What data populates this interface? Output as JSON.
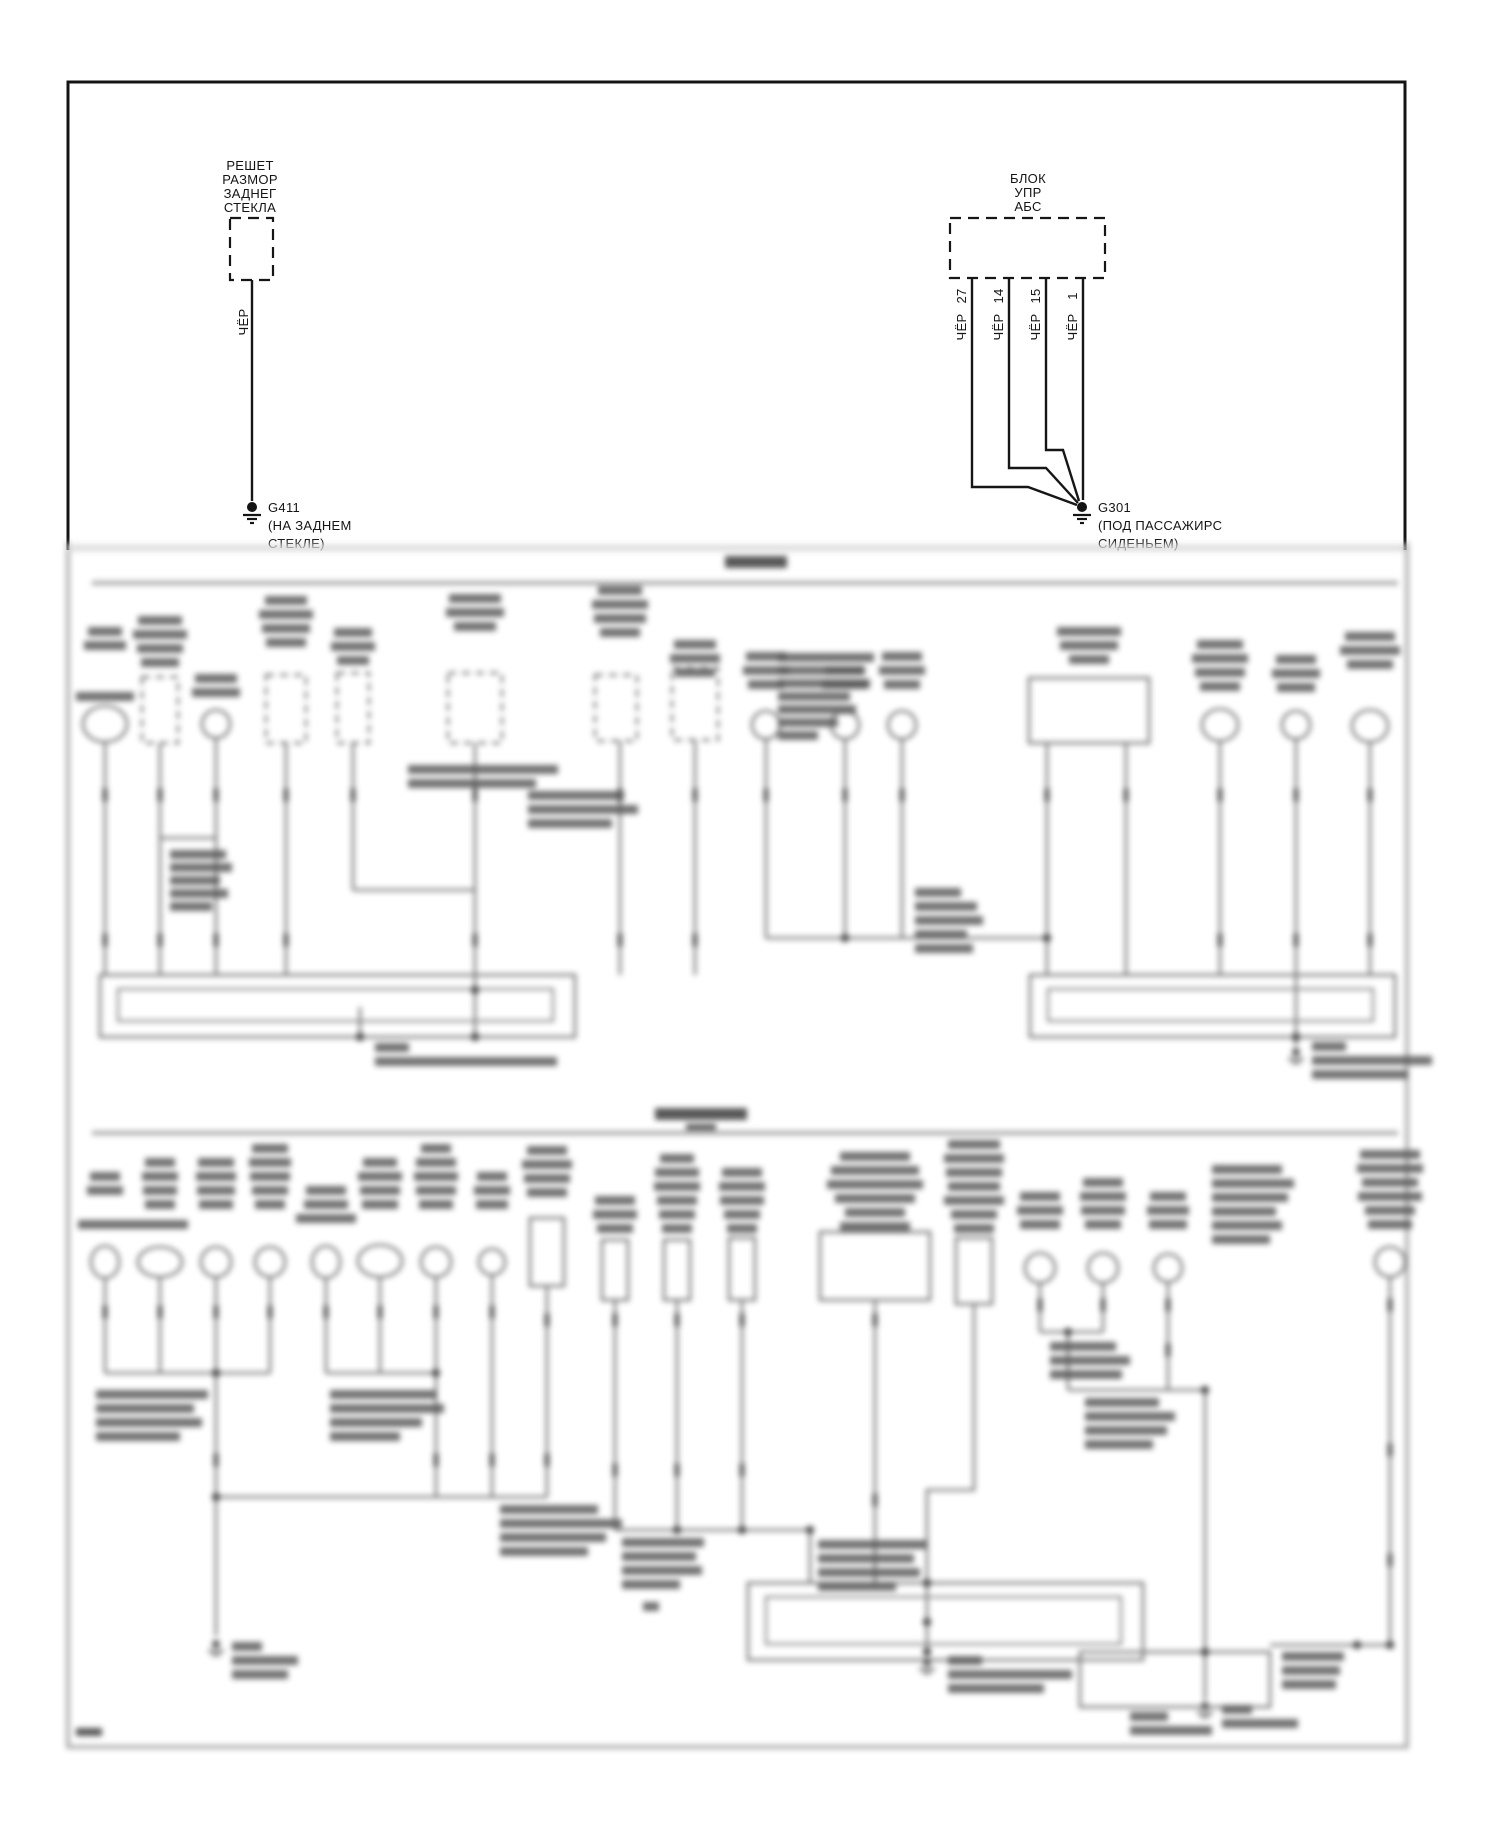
{
  "diagram": {
    "defogger": {
      "name_lines": [
        "РЕШЕТ",
        "РАЗМОР",
        "ЗАДНЕГ",
        "СТЕКЛА"
      ],
      "wire_color": "ЧЁР",
      "ground_id": "G411",
      "ground_location_lines": [
        "(НА ЗАДНЕМ",
        "СТЕКЛЕ)"
      ]
    },
    "abs": {
      "name_lines": [
        "БЛОК",
        "УПР",
        "АБС"
      ],
      "wires": [
        {
          "pin": "27",
          "color": "ЧЁР"
        },
        {
          "pin": "14",
          "color": "ЧЁР"
        },
        {
          "pin": "15",
          "color": "ЧЁР"
        },
        {
          "pin": "1",
          "color": "ЧЁР"
        }
      ],
      "ground_id": "G301",
      "ground_location_lines": [
        "(ПОД ПАССАЖИРС",
        "СИДЕНЬЕМ)"
      ]
    },
    "colors": {
      "line": "#161616",
      "blurred_line": "#6a6a6a",
      "background": "#ffffff"
    }
  }
}
